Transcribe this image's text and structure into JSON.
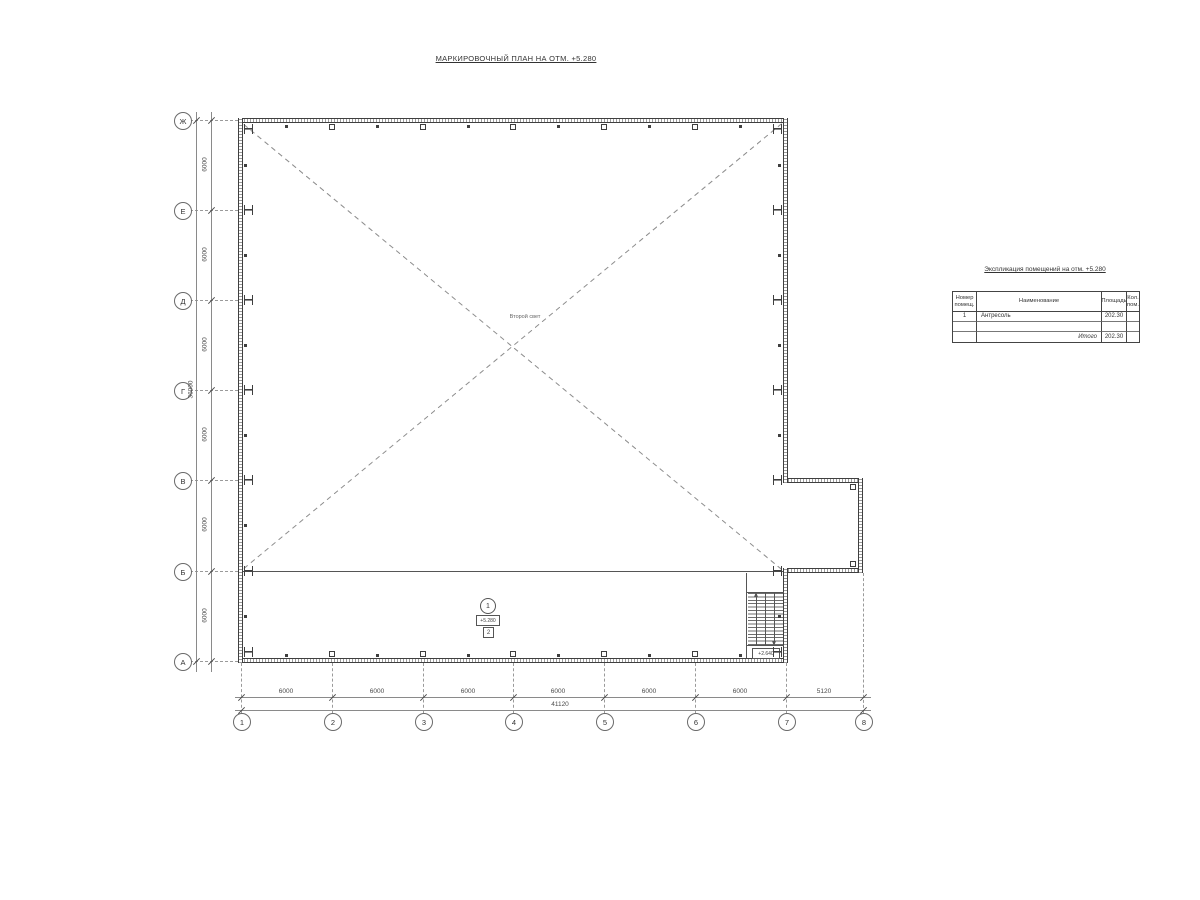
{
  "plan": {
    "title": "МАРКИРОВОЧНЫЙ ПЛАН НА ОТМ. +5.280",
    "void_label": "Второй свет"
  },
  "grid": {
    "rows": [
      "Ж",
      "Е",
      "Д",
      "Г",
      "В",
      "Б",
      "А"
    ],
    "cols": [
      "1",
      "2",
      "3",
      "4",
      "5",
      "6",
      "7",
      "8"
    ]
  },
  "dims": {
    "left": {
      "segments": [
        "6000",
        "6000",
        "6000",
        "6000",
        "6000",
        "6000"
      ],
      "total": "36000"
    },
    "bottom": {
      "segments": [
        "6000",
        "6000",
        "6000",
        "6000",
        "6000",
        "6000",
        "5120"
      ],
      "total": "41120"
    }
  },
  "room_marker": {
    "number": "1",
    "elevation": "+5.280",
    "type_mark": "2"
  },
  "stair": {
    "landing_elevation": "+2.640"
  },
  "table": {
    "title": "Экспликация помещений на отм. +5.280",
    "headers": {
      "number": "Номер помещ.",
      "name": "Наименование",
      "area": "Площадь",
      "count": "Кол. пом."
    },
    "rows": [
      {
        "number": "1",
        "name": "Антресоль",
        "area": "202.30",
        "count": ""
      }
    ],
    "total_label": "Итого",
    "total_area": "202.30"
  },
  "colors": {
    "wall_line": "#3f3f3f",
    "dim_line": "#8a8a8a",
    "background": "#ffffff"
  }
}
